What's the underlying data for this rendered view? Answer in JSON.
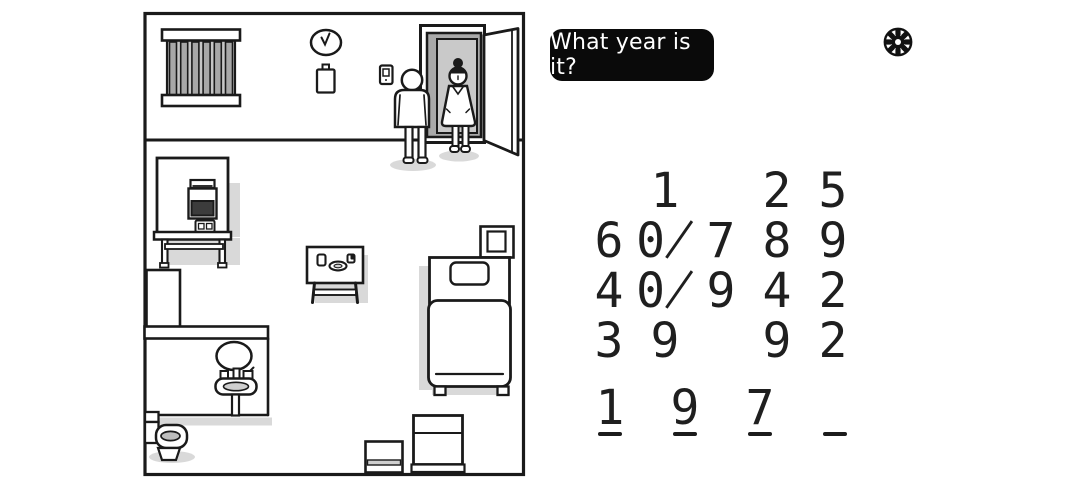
{
  "question_bubble": {
    "text": "What year is it?"
  },
  "settings": {
    "icon": "gear-icon"
  },
  "number_grid": {
    "rows": [
      [
        "",
        "1",
        "",
        "2",
        "5"
      ],
      [
        "6",
        "0̸",
        "7",
        "8",
        "9"
      ],
      [
        "4",
        "0̸",
        "9",
        "4",
        "2"
      ],
      [
        "3",
        "9",
        "",
        "9",
        "2"
      ]
    ]
  },
  "answer": {
    "digits": [
      "1",
      "9",
      "7",
      ""
    ]
  },
  "scene": {
    "objects": [
      "room",
      "barred-window",
      "wall-clock",
      "calendar",
      "light-switch",
      "door",
      "patient",
      "nurse",
      "monitor-machine",
      "machine-table",
      "wall-cabinet",
      "bathroom-partition",
      "mirror",
      "sink",
      "toilet",
      "meal-table",
      "bed",
      "pillow",
      "nightstand",
      "storage-box-small",
      "storage-box-large"
    ]
  },
  "colors": {
    "ink": "#1a1a1a",
    "shadow": "#d9d9d9",
    "door_jamb": "#a9a9a9",
    "door_opening": "#c9c9c9",
    "window_glass": "#c6c6c6",
    "window_bars": "#a8a8a8",
    "screen": "#3c3c3c",
    "water": "#bdbdbd",
    "bubble_bg": "#0a0a0a",
    "bubble_text": "#ffffff",
    "background": "#ffffff"
  }
}
